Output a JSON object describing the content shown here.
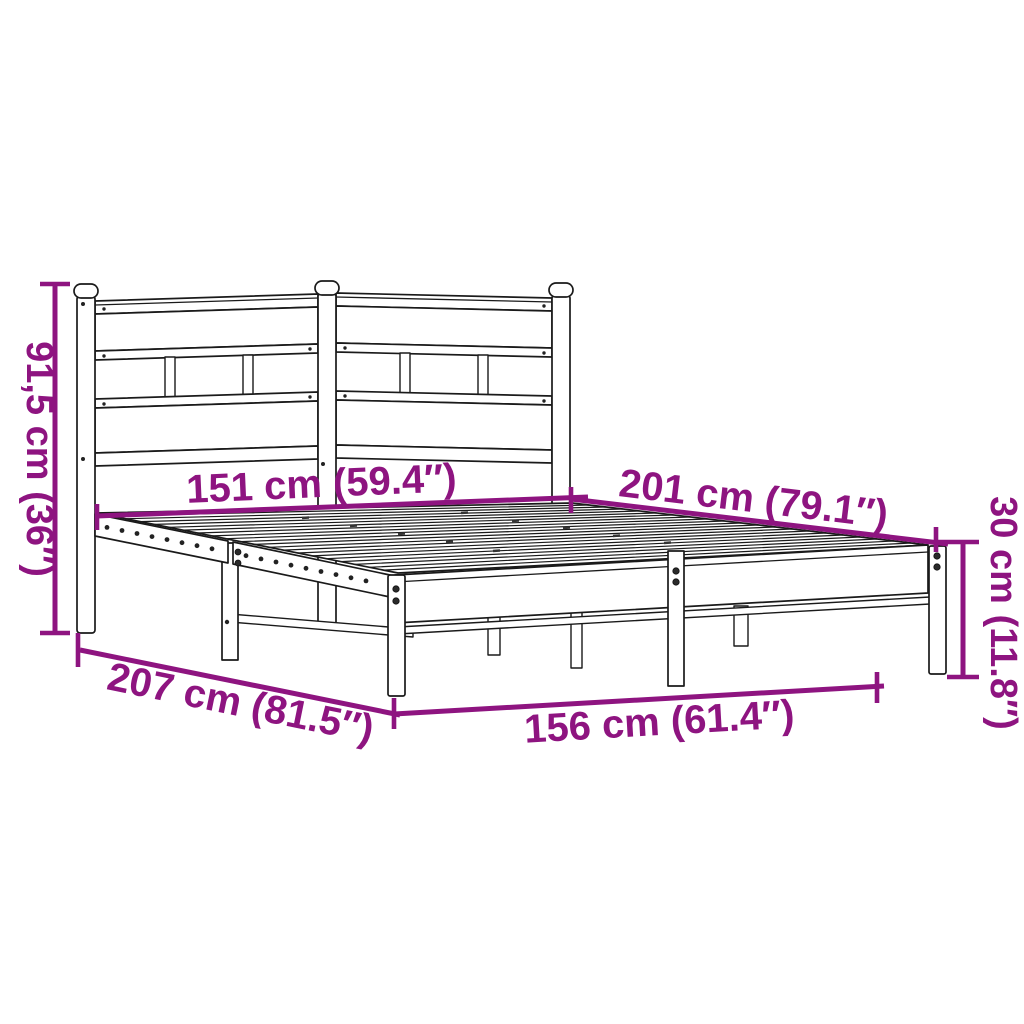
{
  "diagram": {
    "kind": "product-dimension-diagram",
    "subject": "metal bed frame with headboard",
    "colors": {
      "accent": "#8e1480",
      "line": "#1a1a1a",
      "background": "#ffffff"
    },
    "dimensions": {
      "height": {
        "label": "91,5 cm (36″)",
        "cm": "91,5",
        "inches": "36"
      },
      "head_width": {
        "label": "151 cm (59.4″)",
        "cm": "151",
        "inches": "59.4"
      },
      "length_top": {
        "label": "201 cm (79.1″)",
        "cm": "201",
        "inches": "79.1"
      },
      "length_floor": {
        "label": "207 cm (81.5″)",
        "cm": "207",
        "inches": "81.5"
      },
      "foot_width": {
        "label": "156 cm (61.4″)",
        "cm": "156",
        "inches": "61.4"
      },
      "frame_height": {
        "label": "30 cm (11.8″)",
        "cm": "30",
        "inches": "11.8"
      }
    }
  }
}
